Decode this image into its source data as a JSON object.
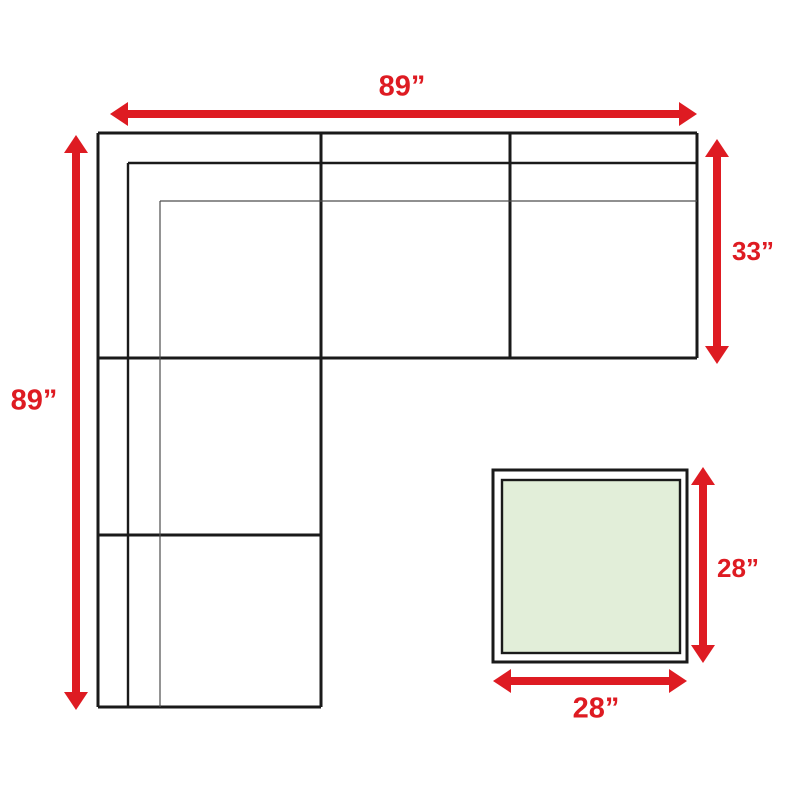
{
  "diagram": {
    "title": "sectional-sofa-dimension-diagram",
    "colors": {
      "background": "#ffffff",
      "line_color": "#1a1a1a",
      "thin_line_color": "#4d4d4d",
      "accent_red": "#de1b22",
      "table_fill": "#e2eed9"
    },
    "labels": {
      "sofa_width": "89”",
      "sofa_length": "89”",
      "seat_depth": "33”",
      "table_height": "28”",
      "table_width": "28”"
    }
  }
}
